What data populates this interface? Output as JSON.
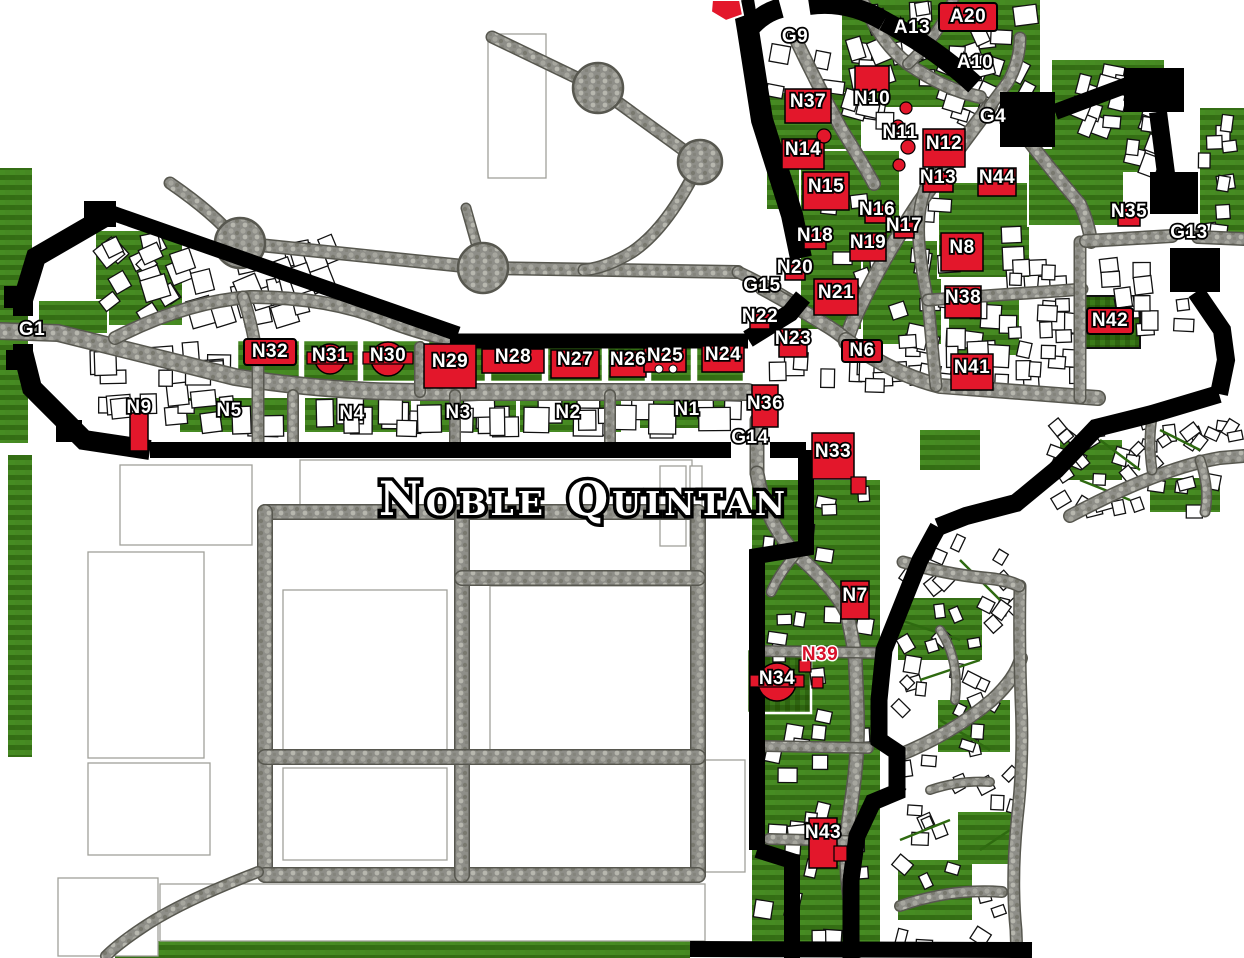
{
  "map": {
    "title": "Noble Quintan",
    "colors": {
      "highlight_red": "#e3172b",
      "wall_black": "#000000",
      "road_gray": "#8e8e88",
      "grass_green": "#3c7a1a",
      "building_white": "#ffffff",
      "label_text": "#ffffff",
      "label_outline": "#000000",
      "red_text_label": "#d8102a"
    },
    "labels": {
      "gates": [
        {
          "id": "G1",
          "x": 32,
          "y": 330
        },
        {
          "id": "G9",
          "x": 795,
          "y": 37
        },
        {
          "id": "G4",
          "x": 993,
          "y": 117
        },
        {
          "id": "G13",
          "x": 1189,
          "y": 233
        },
        {
          "id": "G15",
          "x": 762,
          "y": 286
        },
        {
          "id": "G14",
          "x": 750,
          "y": 438
        }
      ],
      "annex": [
        {
          "id": "A13",
          "x": 912,
          "y": 28,
          "t": "text"
        },
        {
          "id": "A10",
          "x": 975,
          "y": 63,
          "t": "text"
        },
        {
          "id": "A20",
          "x": 968,
          "y": 17,
          "t": "box",
          "w": 58,
          "h": 28
        }
      ],
      "areas": [
        {
          "id": "N5",
          "x": 229,
          "y": 411
        },
        {
          "id": "N4",
          "x": 352,
          "y": 414
        },
        {
          "id": "N3",
          "x": 458,
          "y": 413
        },
        {
          "id": "N2",
          "x": 568,
          "y": 413
        },
        {
          "id": "N1",
          "x": 687,
          "y": 410
        }
      ],
      "buildings": [
        {
          "id": "N32",
          "x": 270,
          "y": 352,
          "t": "box",
          "w": 52,
          "h": 26
        },
        {
          "id": "N31",
          "x": 330,
          "y": 356,
          "t": "circle",
          "r": 15
        },
        {
          "id": "N30",
          "x": 388,
          "y": 356,
          "t": "circle",
          "r": 17
        },
        {
          "id": "N29",
          "x": 450,
          "y": 362,
          "t": "bldg",
          "w": 52,
          "h": 44
        },
        {
          "id": "N28",
          "x": 513,
          "y": 357,
          "t": "bldg",
          "w": 62,
          "h": 24
        },
        {
          "id": "N27",
          "x": 575,
          "y": 360,
          "t": "bldg",
          "w": 48,
          "h": 28
        },
        {
          "id": "N26",
          "x": 628,
          "y": 360,
          "t": "bldg",
          "w": 36,
          "h": 26
        },
        {
          "id": "N25",
          "x": 665,
          "y": 356,
          "t": "bldg",
          "w": 42,
          "h": 24
        },
        {
          "id": "N24",
          "x": 723,
          "y": 355,
          "t": "bldg",
          "w": 42,
          "h": 26
        },
        {
          "id": "N23",
          "x": 793,
          "y": 339,
          "t": "bldg",
          "w": 28,
          "h": 28
        },
        {
          "id": "N22",
          "x": 760,
          "y": 317,
          "t": "bldg",
          "w": 20,
          "h": 16
        },
        {
          "id": "N21",
          "x": 836,
          "y": 293,
          "t": "bldg",
          "w": 44,
          "h": 36
        },
        {
          "id": "N20",
          "x": 795,
          "y": 268,
          "t": "bldg",
          "w": 20,
          "h": 16
        },
        {
          "id": "N19",
          "x": 868,
          "y": 243,
          "t": "bldg",
          "w": 36,
          "h": 28
        },
        {
          "id": "N18",
          "x": 815,
          "y": 236,
          "t": "bldg",
          "w": 22,
          "h": 18
        },
        {
          "id": "N17",
          "x": 904,
          "y": 226,
          "t": "bldg",
          "w": 20,
          "h": 16
        },
        {
          "id": "N16",
          "x": 877,
          "y": 210,
          "t": "bldg",
          "w": 24,
          "h": 18
        },
        {
          "id": "N15",
          "x": 826,
          "y": 187,
          "t": "bldg",
          "w": 46,
          "h": 38
        },
        {
          "id": "N14",
          "x": 803,
          "y": 150,
          "t": "bldg",
          "w": 42,
          "h": 30
        },
        {
          "id": "N13",
          "x": 938,
          "y": 178,
          "t": "bldg",
          "w": 30,
          "h": 20
        },
        {
          "id": "N44",
          "x": 997,
          "y": 178,
          "t": "bldg",
          "w": 38,
          "h": 28
        },
        {
          "id": "N12",
          "x": 944,
          "y": 144,
          "t": "bldg",
          "w": 42,
          "h": 38
        },
        {
          "id": "N11",
          "x": 900,
          "y": 133,
          "t": "text"
        },
        {
          "id": "N10",
          "x": 872,
          "y": 99,
          "t": "bldg",
          "w": 34,
          "h": 26,
          "dy": -20
        },
        {
          "id": "N37",
          "x": 808,
          "y": 102,
          "t": "bldg",
          "w": 46,
          "h": 34
        },
        {
          "id": "N35",
          "x": 1129,
          "y": 212,
          "t": "bldg",
          "w": 22,
          "h": 20
        },
        {
          "id": "N8",
          "x": 962,
          "y": 248,
          "t": "bldg",
          "w": 42,
          "h": 38
        },
        {
          "id": "N38",
          "x": 963,
          "y": 298,
          "t": "bldg",
          "w": 36,
          "h": 32
        },
        {
          "id": "N42",
          "x": 1110,
          "y": 321,
          "t": "box",
          "w": 46,
          "h": 26
        },
        {
          "id": "N6",
          "x": 862,
          "y": 351,
          "t": "box",
          "w": 40,
          "h": 22
        },
        {
          "id": "N41",
          "x": 972,
          "y": 368,
          "t": "bldg",
          "w": 42,
          "h": 36
        },
        {
          "id": "N36",
          "x": 765,
          "y": 404,
          "t": "bldg",
          "w": 26,
          "h": 42,
          "dy": 2
        },
        {
          "id": "N9",
          "x": 139,
          "y": 408,
          "t": "bldg",
          "w": 18,
          "h": 38,
          "dy": 24
        },
        {
          "id": "N33",
          "x": 833,
          "y": 452,
          "t": "bldg",
          "w": 42,
          "h": 46,
          "dy": 4
        },
        {
          "id": "N7",
          "x": 855,
          "y": 596,
          "t": "bldg",
          "w": 28,
          "h": 38
        },
        {
          "id": "N39",
          "x": 820,
          "y": 655,
          "t": "redtext"
        },
        {
          "id": "N34",
          "x": 777,
          "y": 679,
          "t": "circle",
          "r": 19
        },
        {
          "id": "N43",
          "x": 823,
          "y": 833,
          "t": "bldg",
          "w": 28,
          "h": 50,
          "dy": 10
        }
      ]
    },
    "extras": {
      "red_dots": [
        [
          906,
          108,
          6
        ],
        [
          898,
          126,
          6
        ],
        [
          908,
          147,
          7
        ],
        [
          899,
          165,
          6
        ],
        [
          824,
          136,
          7
        ]
      ],
      "red_rects": [
        [
          851,
          477,
          15,
          17
        ],
        [
          834,
          846,
          13,
          15
        ],
        [
          799,
          660,
          12,
          12
        ],
        [
          812,
          677,
          11,
          11
        ]
      ],
      "white_dots": [
        [
          659,
          369,
          4
        ],
        [
          673,
          369,
          4
        ]
      ],
      "partial_marker_points": "712,0 740,0 743,15 726,21 711,12"
    }
  }
}
